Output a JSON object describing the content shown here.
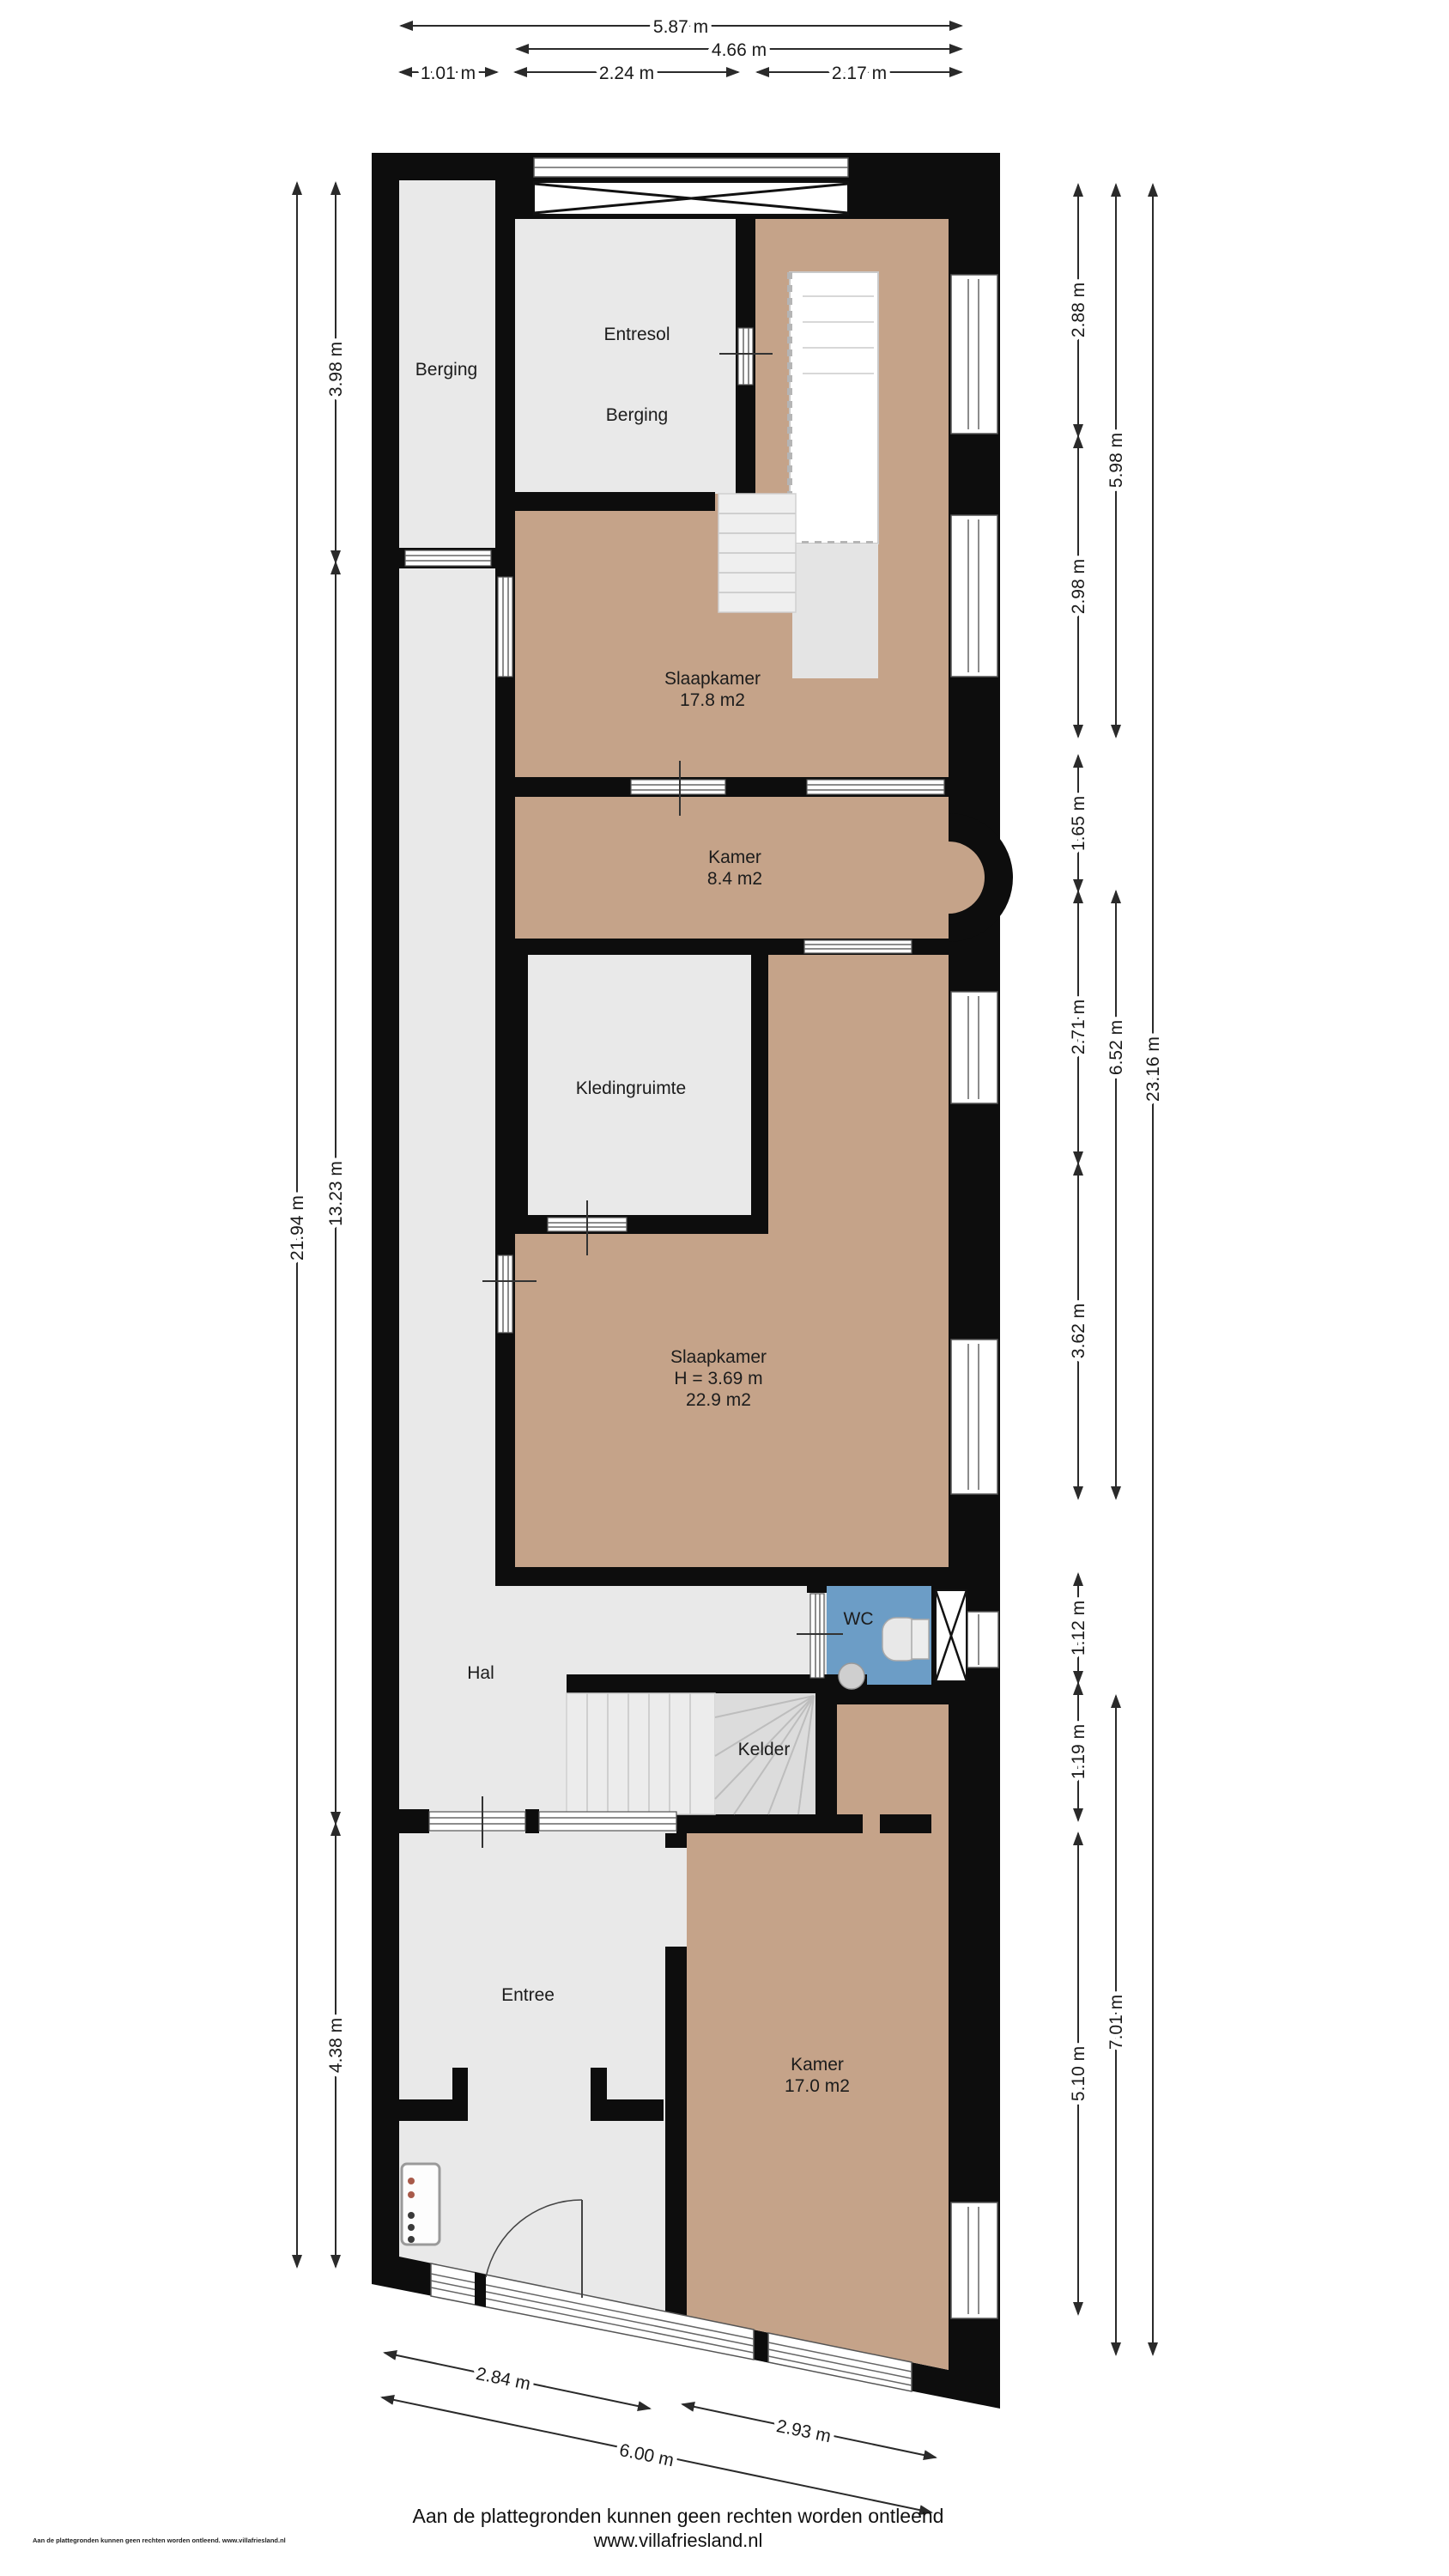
{
  "plan": {
    "rooms": {
      "berging_strip": "Berging",
      "entresol_line1": "Entresol",
      "entresol_line2": "Berging",
      "slaapkamer1_name": "Slaapkamer",
      "slaapkamer1_area": "17.8 m2",
      "kamer1_name": "Kamer",
      "kamer1_area": "8.4 m2",
      "kledingruimte": "Kledingruimte",
      "slaapkamer2_name": "Slaapkamer",
      "slaapkamer2_height": "H = 3.69 m",
      "slaapkamer2_area": "22.9 m2",
      "wc": "WC",
      "hal": "Hal",
      "kelder": "Kelder",
      "entree": "Entree",
      "kamer2_name": "Kamer",
      "kamer2_area": "17.0 m2"
    },
    "dimensions": {
      "top": {
        "total": "5.87 m",
        "inner": "4.66 m",
        "seg1": "1.01 m",
        "seg2": "2.24 m",
        "seg3": "2.17 m"
      },
      "left": {
        "total": "21.94 m",
        "seg1": "3.98 m",
        "seg2": "13.23 m",
        "seg3": "4.38 m"
      },
      "right": {
        "seg1": "2.88 m",
        "seg2": "2.98 m",
        "seg3": "1.65 m",
        "seg4": "2.71 m",
        "seg5": "3.62 m",
        "seg6": "1.12 m",
        "seg7": "1.19 m",
        "seg8": "5.10 m",
        "inner1": "5.98 m",
        "inner2": "6.52 m",
        "inner3": "7.01 m",
        "total": "23.16 m"
      },
      "bottom": {
        "seg1": "2.84 m",
        "seg2": "2.93 m",
        "total": "6.00 m"
      }
    },
    "colors": {
      "wall": "#0d0d0d",
      "room_gray": "#e9e9e9",
      "room_tan": "#c5a389",
      "room_blue": "#6c9dc6",
      "stair_gray": "#ececec"
    }
  },
  "footer": {
    "disclaimer": "Aan de plattegronden kunnen geen rechten worden ontleend",
    "website": "www.villafriesland.nl",
    "watermark": "Aan de plattegronden kunnen geen rechten worden ontleend. www.villafriesland.nl"
  }
}
